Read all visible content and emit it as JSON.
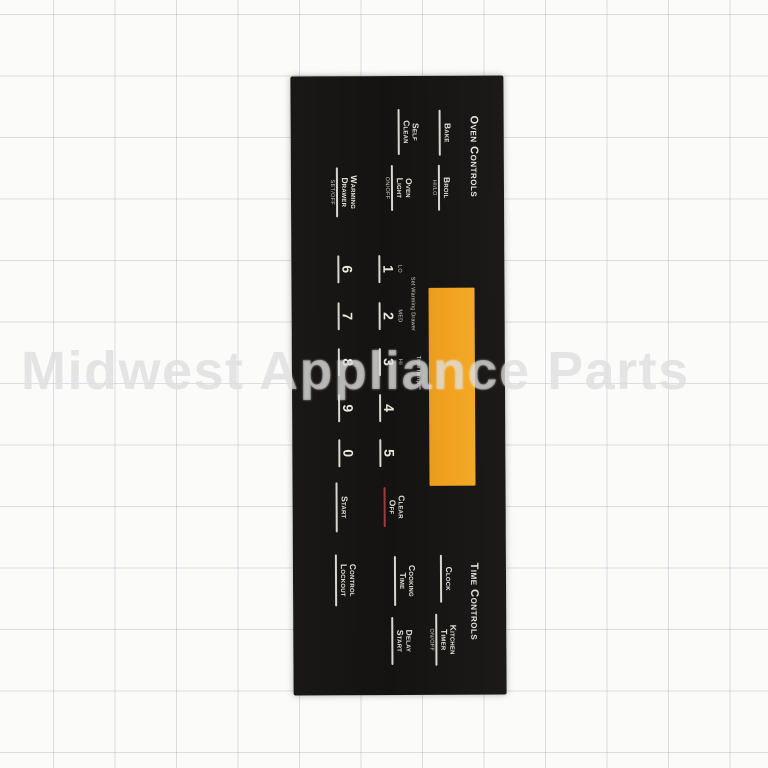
{
  "watermark": "Midwest Appliance Parts",
  "colors": {
    "panel_black": "#151311",
    "display_window_amber": "#F0A01E",
    "print_white": "#E6E3DC",
    "clear_off_underline_red": "#A03A3E",
    "grid_line": "#A5AAB9",
    "paper_background": "#FBFBFA"
  },
  "panel": {
    "oven_controls": {
      "title": "Oven Controls",
      "bake": {
        "label": "Bake"
      },
      "self_clean": {
        "label": "Self Clean"
      },
      "broil": {
        "label": "Broil",
        "sub": "HI/LO"
      },
      "oven_light": {
        "label": "Oven Light",
        "sub": "ON/OFF"
      },
      "warming_drawer": {
        "label": "Warming Drawer",
        "sub": "SET/OFF"
      }
    },
    "display": {
      "description": "blank amber display window",
      "color": "#F0A01E"
    },
    "keypad": {
      "set_warming_drawer_note": "Set Warming Drawer",
      "truetemp_note": "TrueTemp™",
      "keys_row1": [
        {
          "sub": "LO",
          "label": "1"
        },
        {
          "sub": "MED",
          "label": "2"
        },
        {
          "sub": "HI",
          "label": "3"
        },
        {
          "label": "4"
        },
        {
          "label": "5"
        }
      ],
      "clear_off": {
        "label": "Clear Off"
      },
      "keys_row2": [
        {
          "label": "6"
        },
        {
          "label": "7"
        },
        {
          "label": "8"
        },
        {
          "label": "9"
        },
        {
          "label": "0"
        }
      ],
      "start": {
        "label": "Start"
      }
    },
    "time_controls": {
      "title": "Time Controls",
      "clock": {
        "label": "Clock"
      },
      "kitchen_timer": {
        "label": "Kitchen Timer",
        "sub": "ON/OFF"
      },
      "cooking_time": {
        "label": "Cooking Time"
      },
      "delay_start": {
        "label": "Delay Start"
      },
      "control_lockout": {
        "label": "Control Lockout"
      }
    }
  }
}
